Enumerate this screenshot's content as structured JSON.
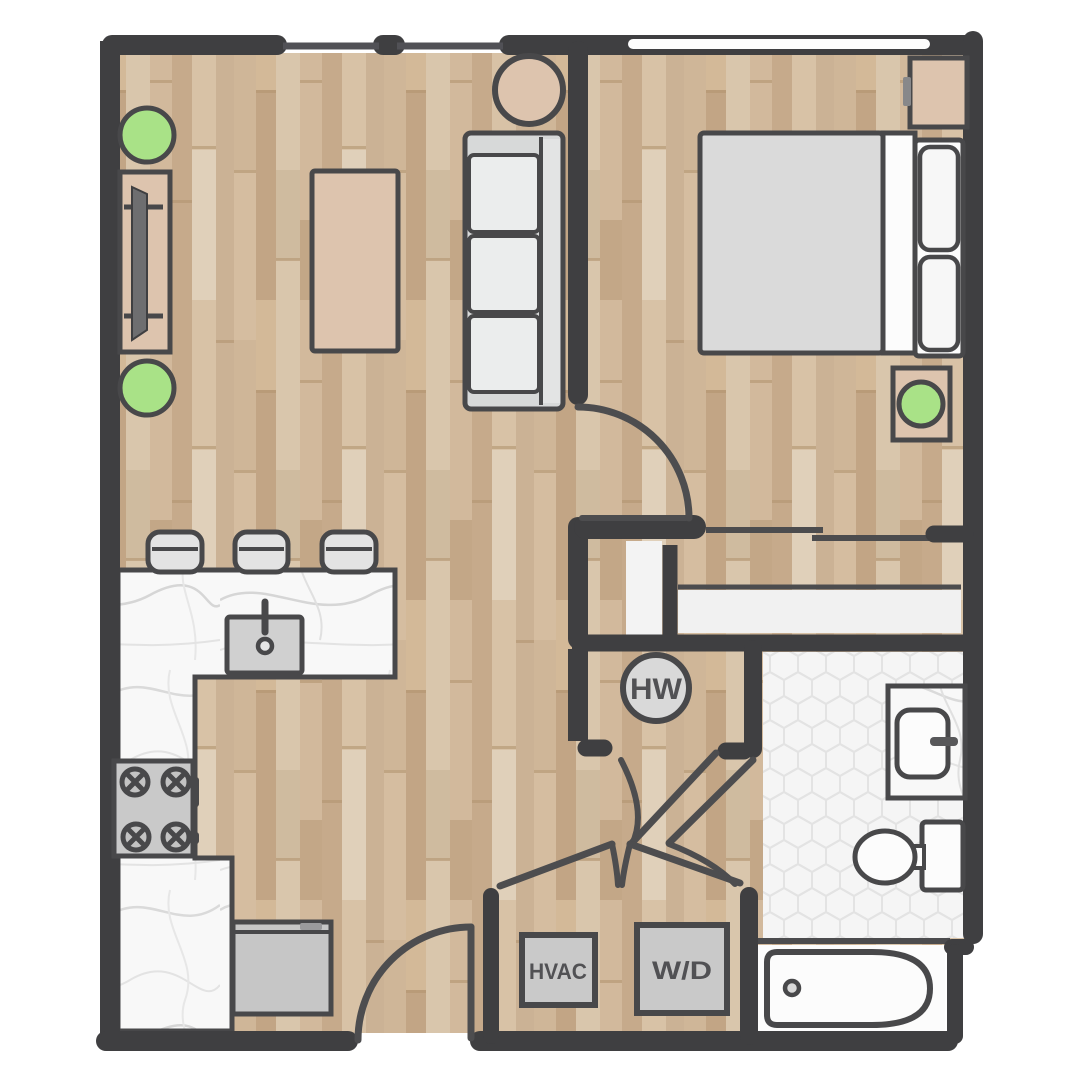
{
  "title": "One-bedroom apartment floor plan",
  "labels": {
    "hot_water": "HW",
    "hvac": "HVAC",
    "washer_dryer": "W/D"
  },
  "colors": {
    "wall": "#3f3f41",
    "line": "#4c4c4e",
    "door_line": "#4d4d4f",
    "outline": "#48484a",
    "wood_base": "#cdb499",
    "marble": "#f8f8f8",
    "marble_vein": "#dadada",
    "hex_bg": "#f5f5f5",
    "hex_line": "#e3e3e3",
    "closet_floor": "#f1f1f1",
    "niche_floor": "#f3f3f3",
    "appliance_gray": "#c9c9c9",
    "upholstery": "#ebeded",
    "sofa_base": "#d7d9d9",
    "mattress": "#dadada",
    "bedding_white": "#fcfcfc",
    "furniture_tan": "#ddc4ae",
    "plant_green": "#a9e287",
    "stool_gray": "#e3e3e3",
    "window_white": "#fdfdfd",
    "label_text": "#515154"
  },
  "symbols": [
    "tv-console",
    "tv",
    "plant",
    "coffee-table",
    "sofa",
    "round-side-table",
    "bed",
    "pillow",
    "nightstand",
    "sliding-closet-door",
    "bar-stool",
    "kitchen-sink",
    "faucet",
    "stove",
    "refrigerator",
    "hot-water-heater",
    "hvac-unit",
    "washer-dryer",
    "bathroom-vanity",
    "toilet",
    "bathtub",
    "door-swing",
    "window"
  ]
}
